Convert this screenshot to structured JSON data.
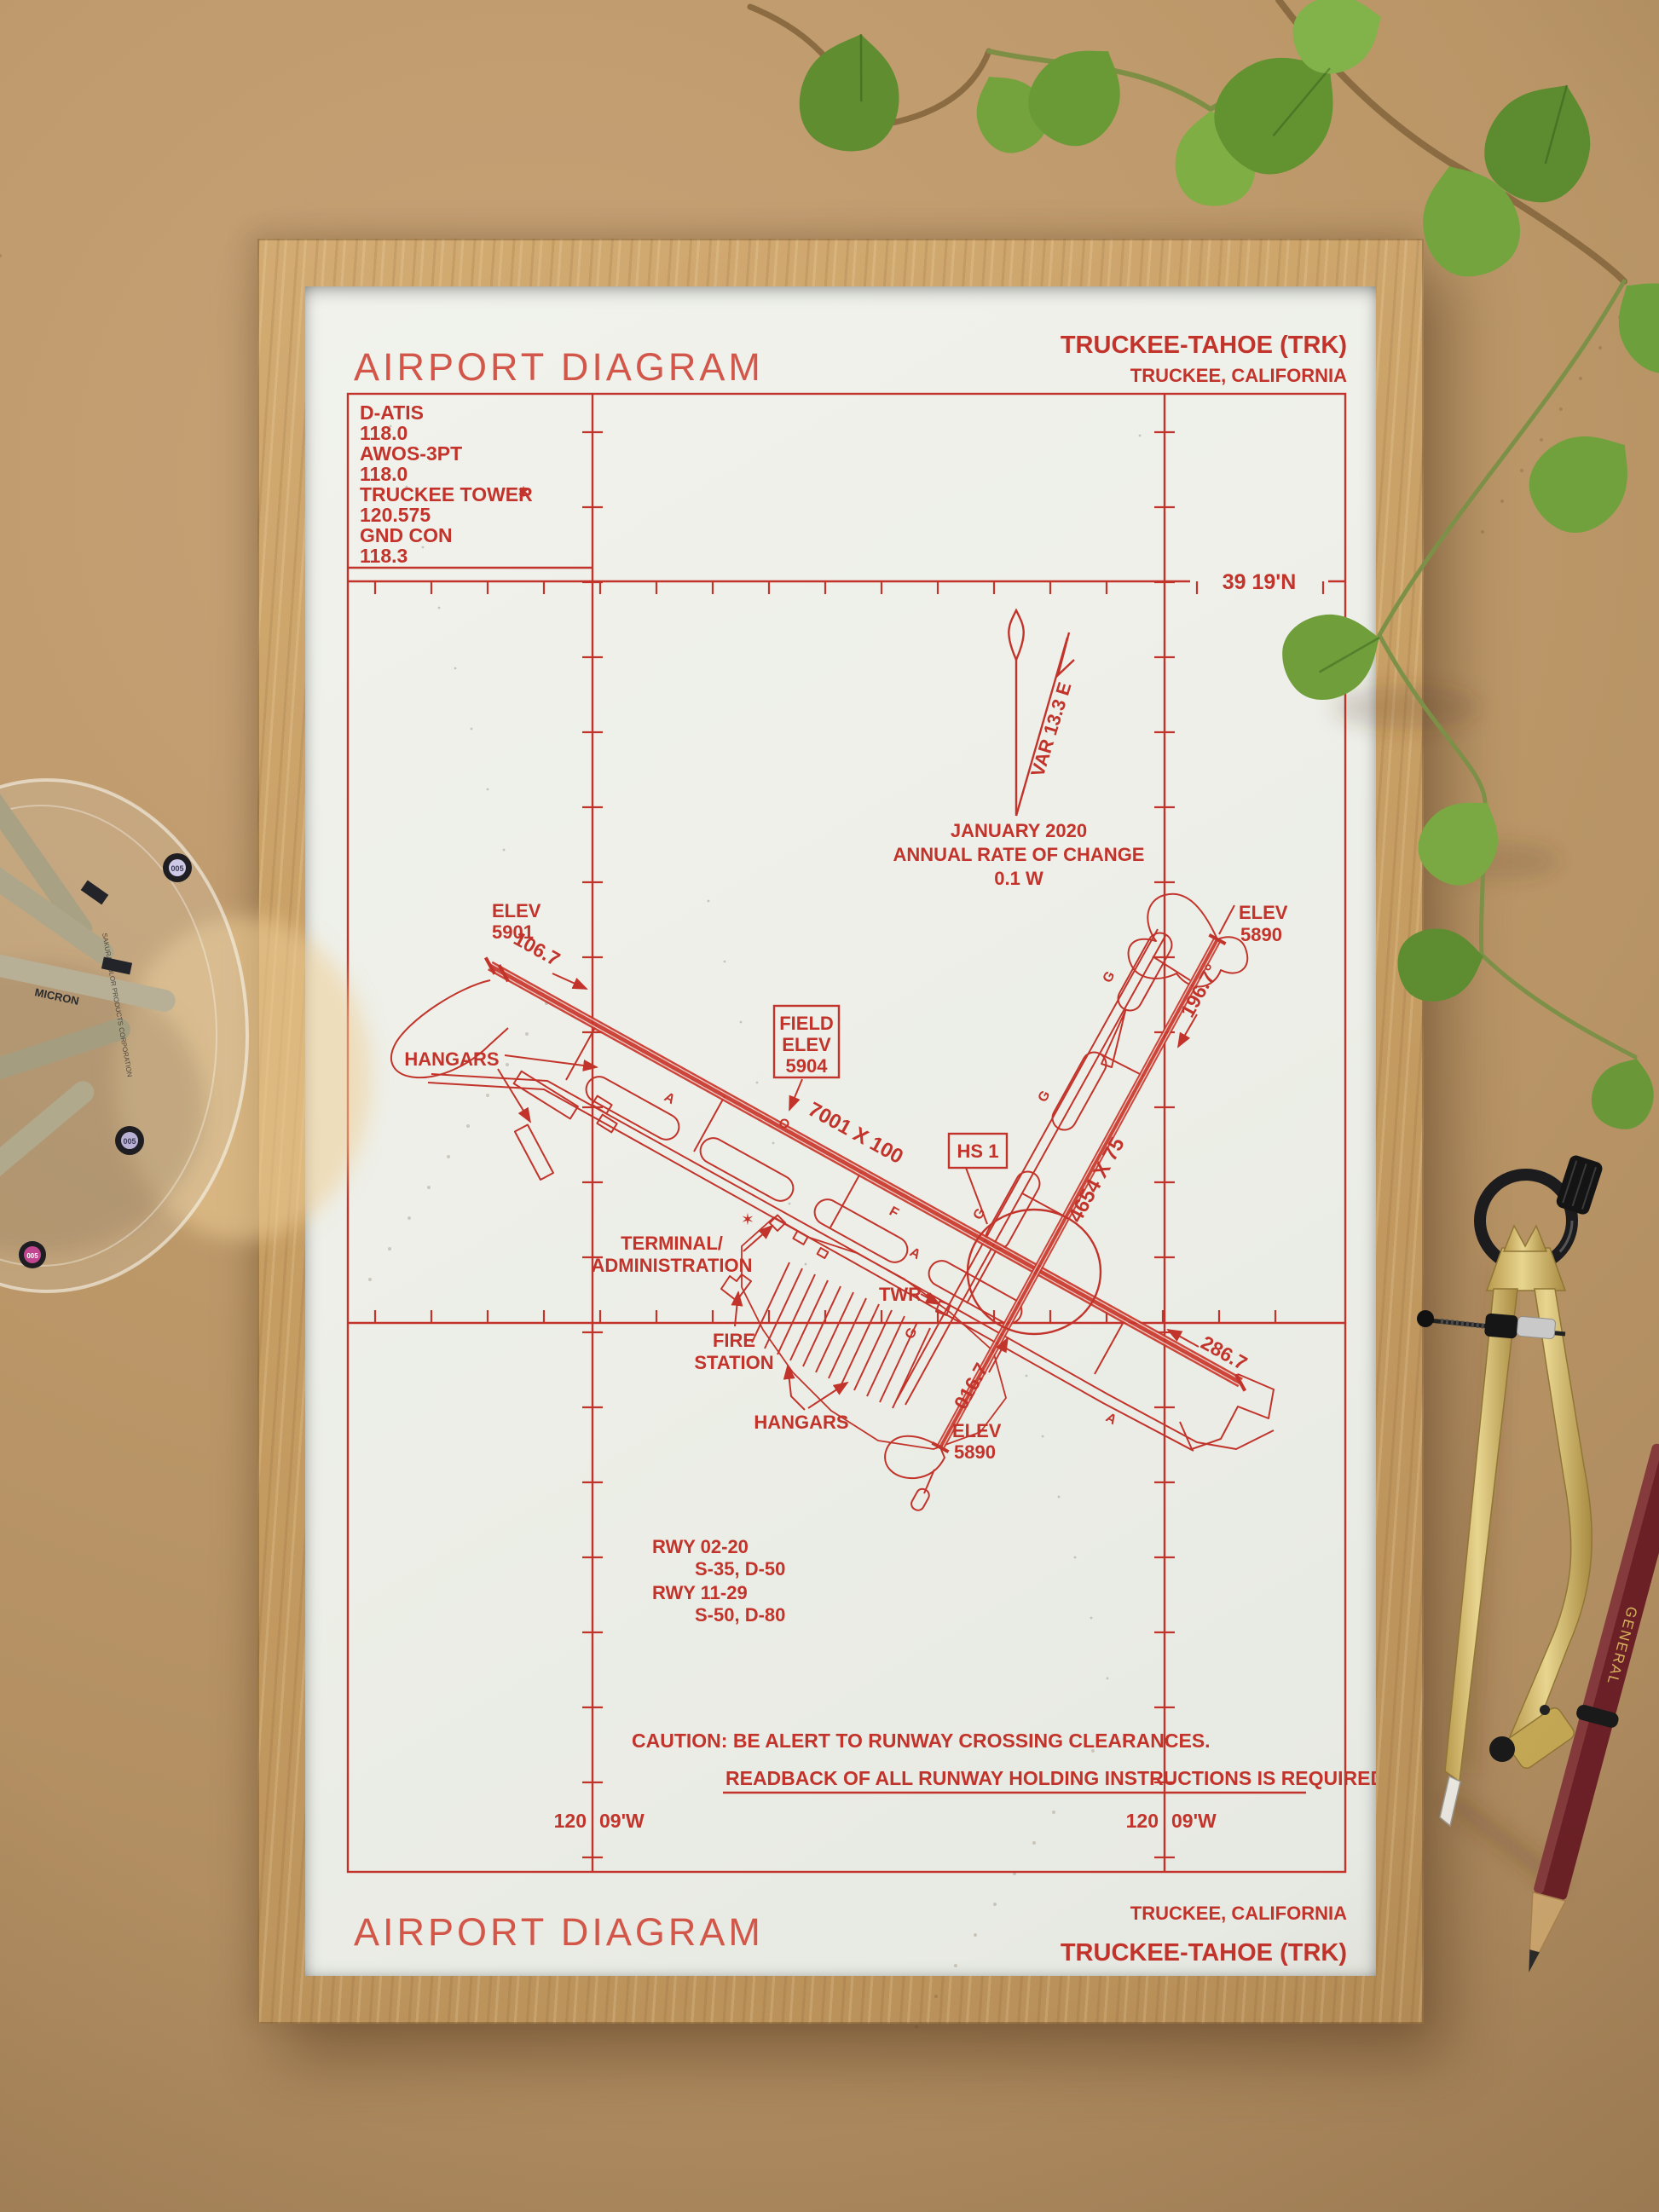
{
  "colors": {
    "ink": "#c2342b",
    "paper": "#edefe9",
    "frame_wood": "#c9a166",
    "desk": "#bb9768",
    "leaf_green": "#6f9e3a",
    "pencil_maroon": "#6b2026",
    "compass_brass": "#d9c078"
  },
  "chart": {
    "title": "AIRPORT DIAGRAM",
    "airport": "TRUCKEE-TAHOE (TRK)",
    "city": "TRUCKEE, CALIFORNIA",
    "frequencies": [
      "D-ATIS",
      "118.0",
      "AWOS-3PT",
      "118.0",
      "TRUCKEE TOWER",
      "120.575",
      "GND CON",
      "118.3"
    ],
    "lat_label": "39 19'N",
    "lon_left": "120",
    "lon_right": "09'W",
    "compass": {
      "var": "VAR 13.3 E",
      "date": "JANUARY 2020",
      "rate": "ANNUAL RATE OF CHANGE",
      "value": "0.1  W"
    },
    "field_elev": [
      "FIELD",
      "ELEV",
      "5904"
    ],
    "hotspot": "HS 1",
    "rwy_1129_dim": "7001 X 100",
    "rwy_0220_dim": "4654 X 75",
    "hdg_11": "106.7",
    "hdg_29": "286.7",
    "hdg_20": "196.7°",
    "hdg_02": "016.7",
    "elev_11": [
      "ELEV",
      "5901"
    ],
    "elev_20": [
      "ELEV",
      "5890"
    ],
    "elev_02": [
      "ELEV",
      "5890"
    ],
    "labels": {
      "hangars_nw": "HANGARS",
      "hangars_s": "HANGARS",
      "terminal": [
        "TERMINAL/",
        "ADMINISTRATION"
      ],
      "fire": [
        "FIRE",
        "STATION"
      ],
      "twr": "TWR"
    },
    "taxiway": {
      "a": "A",
      "g": "G",
      "f": "F"
    },
    "rwy_data": [
      "RWY 02-20",
      "S-35, D-50",
      "RWY 11-29",
      "S-50, D-80"
    ],
    "caution1": "CAUTION: BE ALERT TO RUNWAY CROSSING CLEARANCES.",
    "caution2": "READBACK OF ALL RUNWAY HOLDING INSTRUCTIONS IS REQUIRED.",
    "footer": {
      "title": "AIRPORT DIAGRAM",
      "city": "TRUCKEE, CALIFORNIA",
      "airport": "TRUCKEE-TAHOE (TRK)"
    }
  },
  "objects": {
    "pen_size": "005",
    "pen_brand": "MICRON",
    "pen_fine_print": "SAKURA COLOR PRODUCTS CORPORATION",
    "pencil_brand": "GENERAL"
  }
}
